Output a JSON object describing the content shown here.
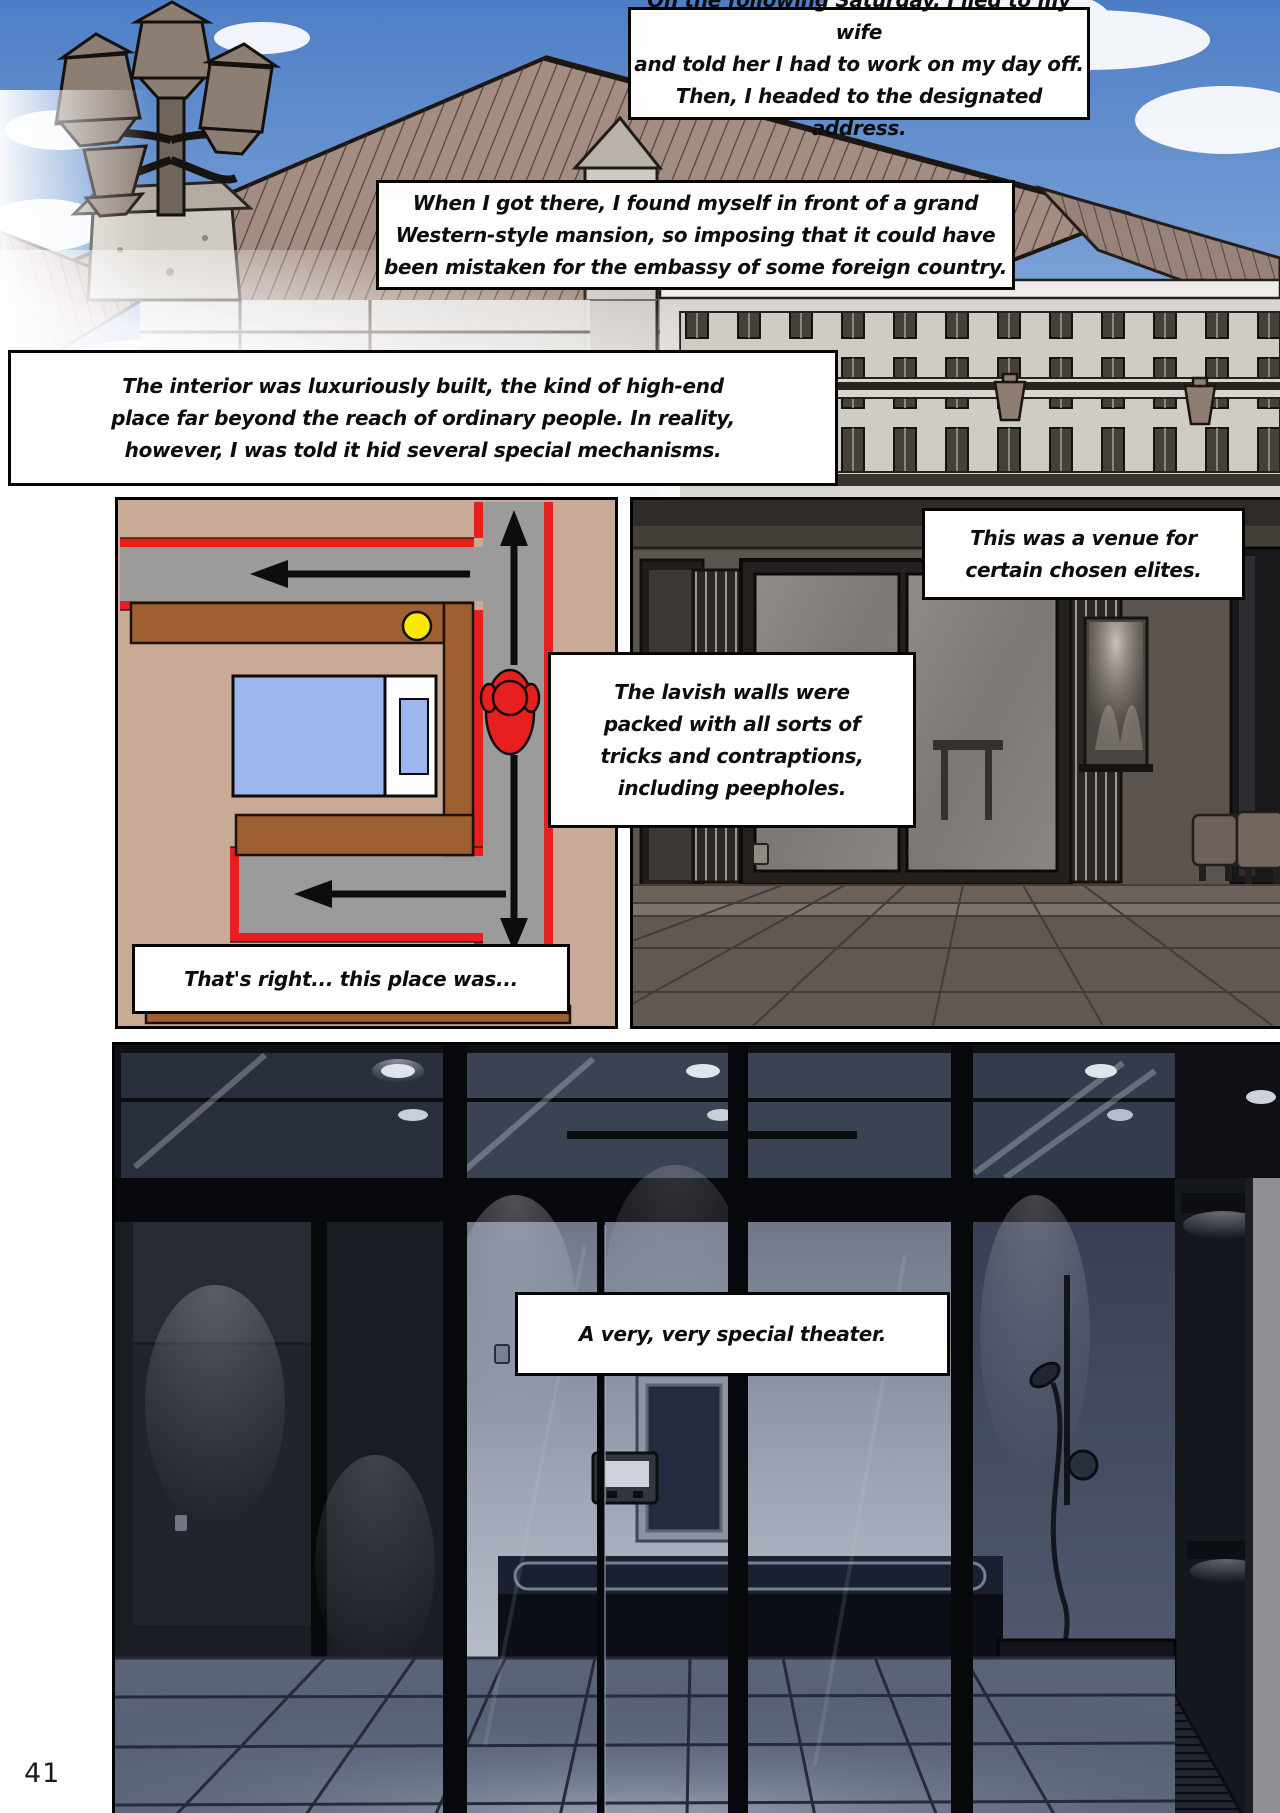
{
  "page": {
    "number": "41"
  },
  "captions": [
    {
      "id": "narration-1",
      "text": "On the following Saturday, I lied to my wife\nand told her I had to work on my day off.\nThen, I headed to the designated address."
    },
    {
      "id": "narration-2",
      "text": "When I got there, I found myself in front of a grand\nWestern-style mansion, so imposing that it could have\nbeen mistaken for the embassy of some foreign country."
    },
    {
      "id": "narration-3",
      "text": "The interior was luxuriously built, the kind of high-end\nplace far beyond the reach of ordinary people. In reality,\nhowever, I was told it hid several special mechanisms."
    },
    {
      "id": "narration-4",
      "text": "This was a venue for\ncertain chosen elites."
    },
    {
      "id": "narration-5",
      "text": "The lavish walls were\npacked with all sorts of\ntricks and contraptions,\nincluding peepholes."
    },
    {
      "id": "narration-6",
      "text": "That's right... this place was..."
    },
    {
      "id": "narration-7",
      "text": "A very, very special theater."
    }
  ],
  "floorplan_legend": {
    "secret_corridor_color": "#9b9b9b",
    "trick_wall_color": "#e81f1f",
    "room_wall_color": "#9e5f31",
    "peephole_marker_color": "#ffe800",
    "observer_color": "#e81f1f",
    "bed_color": "#9db6ec",
    "floor_color": "#c9aa97"
  }
}
